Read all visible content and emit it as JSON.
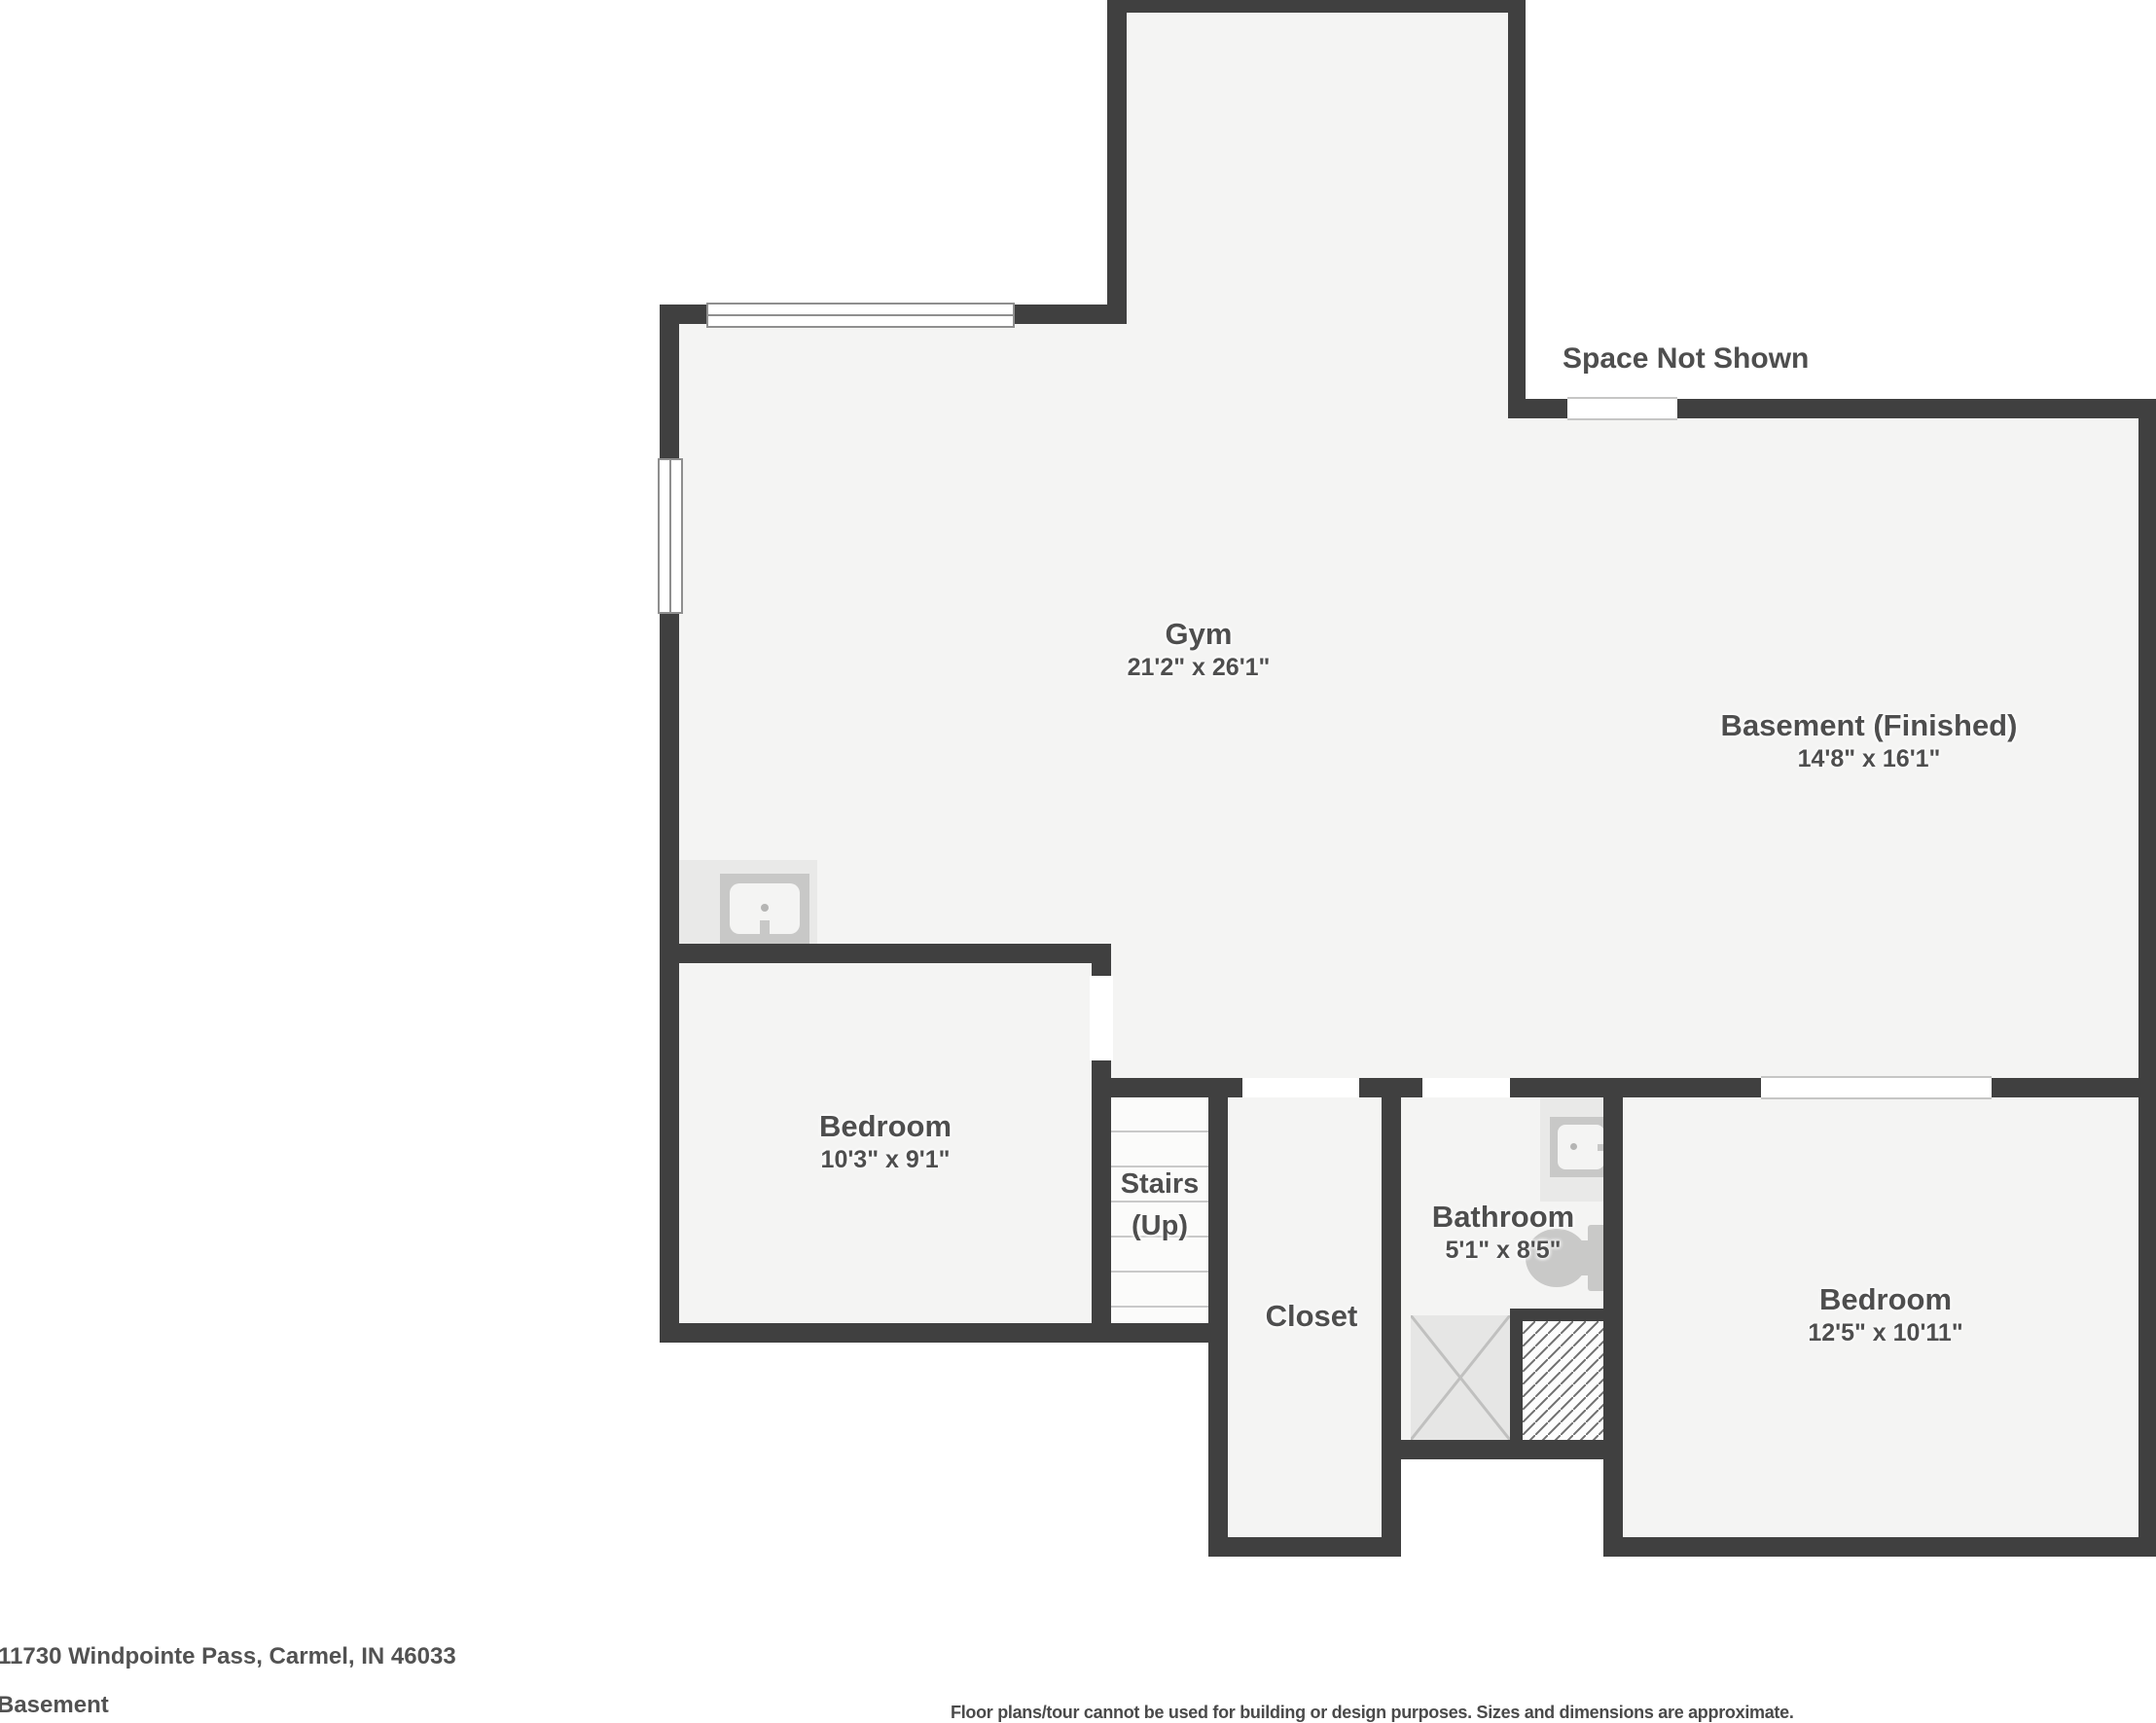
{
  "colors": {
    "wall": "#404040",
    "floor": "#f4f4f3",
    "stair_floor": "#fbfbfa",
    "tread": "#c9c9c9",
    "fixture_bg": "#e9e9e8",
    "fixture_mid": "#c8c8c7",
    "fixture_dot": "#b5b5b4",
    "text": "#4e4e4e"
  },
  "rooms": [
    {
      "id": "gym",
      "name": "Gym",
      "dims": "21'2\" x 26'1\""
    },
    {
      "id": "basement-finished",
      "name": "Basement (Finished)",
      "dims": "14'8\" x 16'1\""
    },
    {
      "id": "bedroom-left",
      "name": "Bedroom",
      "dims": "10'3\" x 9'1\""
    },
    {
      "id": "stairs",
      "name": "Stairs",
      "name2": "(Up)"
    },
    {
      "id": "closet",
      "name": "Closet"
    },
    {
      "id": "bathroom",
      "name": "Bathroom",
      "dims": "5'1\" x 8'5\""
    },
    {
      "id": "bedroom-right",
      "name": "Bedroom",
      "dims": "12'5\" x 10'11\""
    }
  ],
  "annotations": {
    "space_not_shown": "Space Not Shown"
  },
  "footer": {
    "address": "11730 Windpointe Pass, Carmel, IN 46033",
    "level": "Basement",
    "disclaimer": "Floor plans/tour cannot be used for building or design purposes. Sizes and dimensions are approximate."
  }
}
